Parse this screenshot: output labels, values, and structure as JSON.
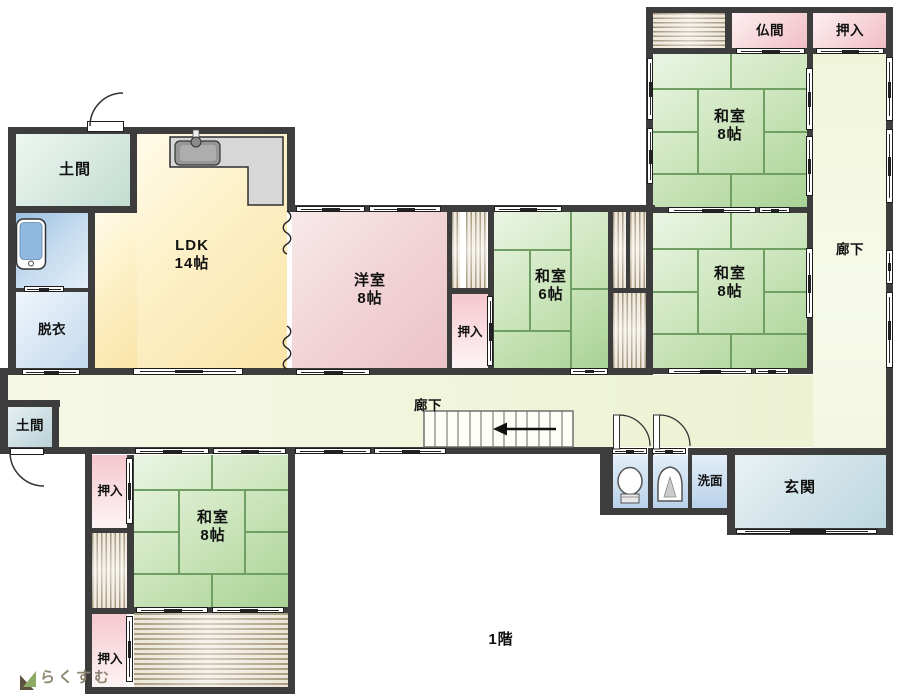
{
  "floor_label": "1階",
  "logo_text": "らくすむ",
  "rooms": {
    "doma_top": {
      "label": "土間"
    },
    "ldk": {
      "label": "LDK",
      "size": "14帖"
    },
    "datsui": {
      "label": "脱衣"
    },
    "youshitsu": {
      "label": "洋室",
      "size": "8帖"
    },
    "oshiire_mid": {
      "label": "押入"
    },
    "washitsu6": {
      "label": "和室",
      "size": "6帖"
    },
    "washitsu8_top": {
      "label": "和室",
      "size": "8帖"
    },
    "washitsu8_mid": {
      "label": "和室",
      "size": "8帖"
    },
    "washitsu8_bottom": {
      "label": "和室",
      "size": "8帖"
    },
    "butsuma": {
      "label": "仏間"
    },
    "oshiire_top_right": {
      "label": "押入"
    },
    "rouka_right": {
      "label": "廊下"
    },
    "rouka_main": {
      "label": "廊下"
    },
    "doma_bottom": {
      "label": "土間"
    },
    "oshiire_bl_top": {
      "label": "押入"
    },
    "oshiire_bl_bottom": {
      "label": "押入"
    },
    "senmen": {
      "label": "洗面"
    },
    "genkan": {
      "label": "玄関"
    }
  },
  "colors": {
    "wall": "#3d3d3d",
    "tatami_line": "#6f9f63",
    "arrow": "#111111"
  }
}
